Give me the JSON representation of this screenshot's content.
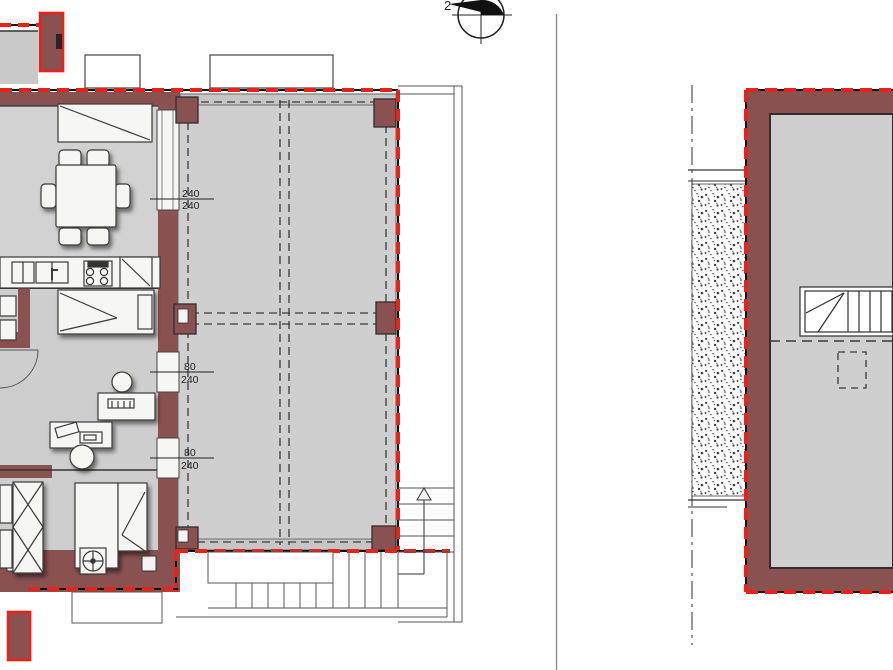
{
  "labels": {
    "dim_a": {
      "num": "240",
      "den": "240"
    },
    "dim_b": {
      "num": "80",
      "den": "240"
    },
    "dim_c": {
      "num": "80",
      "den": "240"
    },
    "compass_text": "2"
  },
  "colors": {
    "background": "#ffffff",
    "wall": "#8a5151",
    "demolition_red": "#e8231a",
    "floor_gray": "#d2d2d2",
    "beam_gray": "#c6c6c6",
    "furniture_white": "#f6f6f3",
    "line_dark": "#2f2f2f",
    "separator_gray": "#8f8f8f",
    "stipple_dot": "#4a4a4a"
  },
  "icons": [
    "north-compass-icon",
    "dining-table-chairs",
    "kitchen-counter",
    "sink",
    "stove",
    "cabinet",
    "double-bed",
    "single-bed",
    "wardrobe",
    "desk",
    "desk-chair",
    "door-swing-arc",
    "column-symbol",
    "boiler-symbol",
    "external-staircase",
    "internal-staircase",
    "stair-up-arrow",
    "gravel-hatch",
    "property-line",
    "demolition-dashed-line"
  ]
}
